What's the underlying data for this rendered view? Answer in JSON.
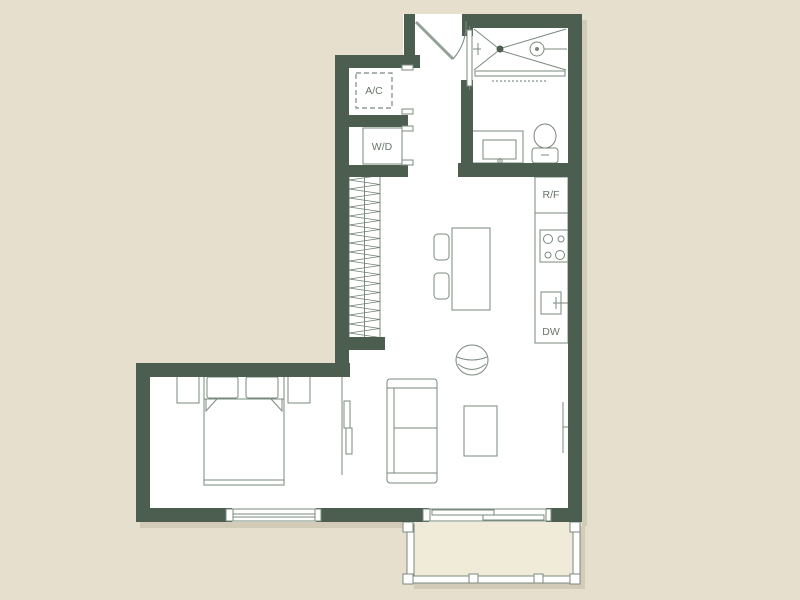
{
  "title": "Studio apartment floor plan",
  "labels": {
    "ac": "A/C",
    "wd": "W/D",
    "rf": "R/F",
    "dw": "DW"
  },
  "colors": {
    "background": "#e6dfcd",
    "wall": "#4c5e50",
    "line": "#7a897d",
    "text": "#66766a",
    "floor": "#ffffff",
    "balcony": "#f0ead9"
  }
}
